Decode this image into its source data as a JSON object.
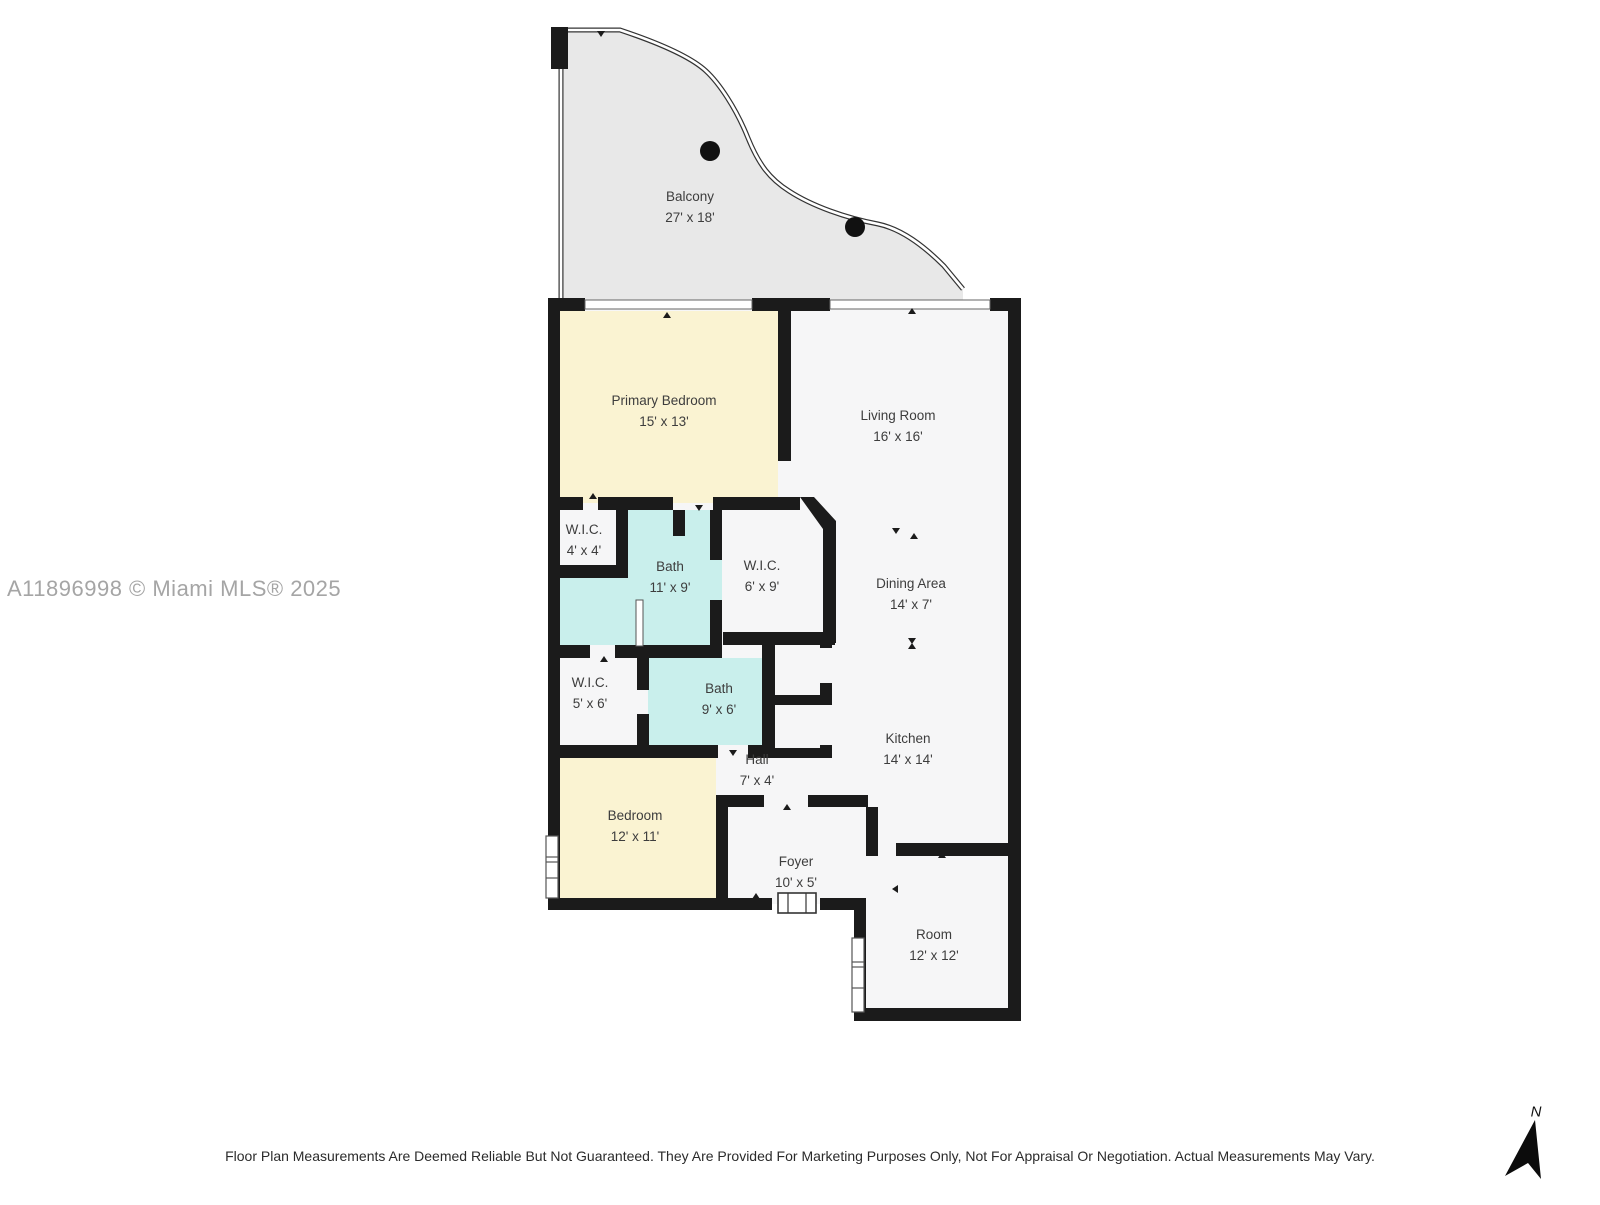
{
  "watermark": "A11896998 © Miami MLS® 2025",
  "disclaimer": "Floor Plan Measurements Are Deemed Reliable But Not Guaranteed. They Are Provided For Marketing Purposes Only, Not For Appraisal Or Negotiation. Actual Measurements May Vary.",
  "compass": {
    "label": "N"
  },
  "colors": {
    "wall": "#1b1b1b",
    "bedroom_fill": "#faf3d2",
    "bath_fill": "#c9efec",
    "balcony_fill": "#e8e8e8",
    "floor_fill": "#f6f6f7"
  },
  "rooms": [
    {
      "id": "balcony",
      "name": "Balcony",
      "dims": "27' x 18'"
    },
    {
      "id": "primary-bedroom",
      "name": "Primary Bedroom",
      "dims": "15' x 13'"
    },
    {
      "id": "living-room",
      "name": "Living Room",
      "dims": "16' x 16'"
    },
    {
      "id": "wic-1",
      "name": "W.I.C.",
      "dims": "4' x 4'"
    },
    {
      "id": "bath-1",
      "name": "Bath",
      "dims": "11' x 9'"
    },
    {
      "id": "wic-2",
      "name": "W.I.C.",
      "dims": "6' x 9'"
    },
    {
      "id": "dining-area",
      "name": "Dining Area",
      "dims": "14' x 7'"
    },
    {
      "id": "wic-3",
      "name": "W.I.C.",
      "dims": "5' x 6'"
    },
    {
      "id": "bath-2",
      "name": "Bath",
      "dims": "9' x 6'"
    },
    {
      "id": "kitchen",
      "name": "Kitchen",
      "dims": "14' x 14'"
    },
    {
      "id": "hall",
      "name": "Hall",
      "dims": "7' x 4'"
    },
    {
      "id": "bedroom",
      "name": "Bedroom",
      "dims": "12' x 11'"
    },
    {
      "id": "foyer",
      "name": "Foyer",
      "dims": "10' x 5'"
    },
    {
      "id": "room",
      "name": "Room",
      "dims": "12' x 12'"
    }
  ]
}
